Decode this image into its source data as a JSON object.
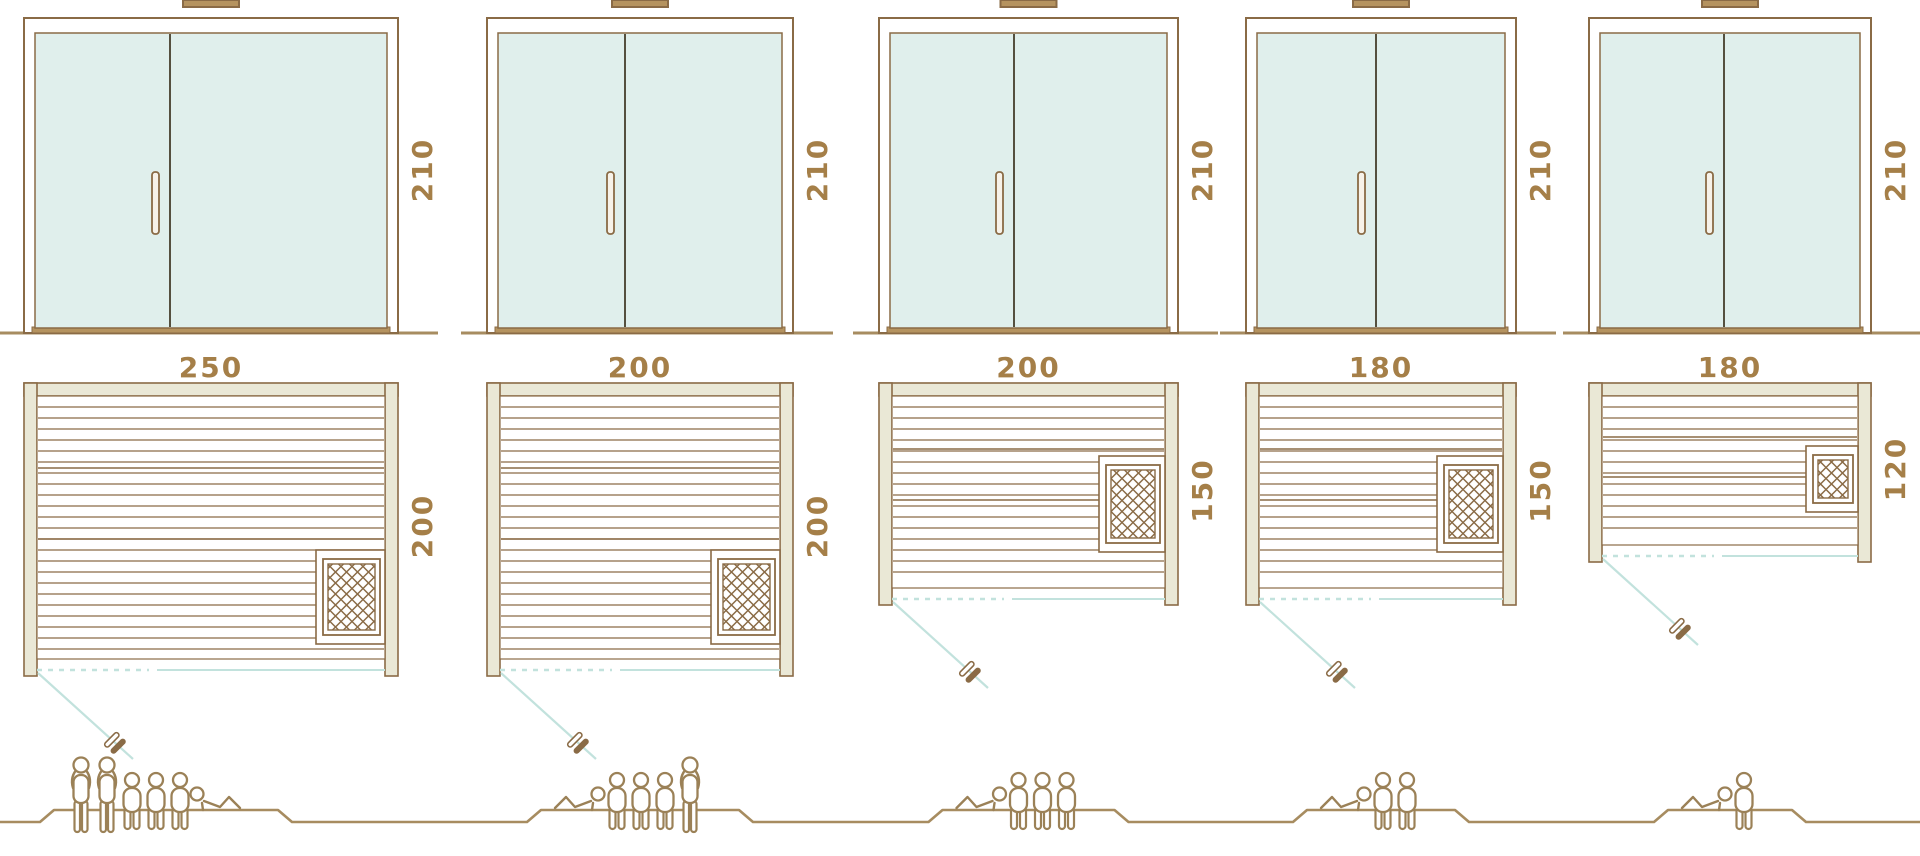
{
  "diagram_title": "sauna-models-size-comparison",
  "colors": {
    "line_brown": "#8a6b46",
    "ground_brown": "#a78c60",
    "label_brown": "#a57f48",
    "glass_teal": "#e0efec",
    "wall_beige": "#eae8d6",
    "swing_teal": "#c2e2dd",
    "divider_dark": "#55503f",
    "figure_brown": "#9b8157",
    "vent_fill": "#b5935f",
    "handle_fill": "#f7f2e9"
  },
  "models": [
    {
      "id": "sauna-250x200",
      "width_label": "250",
      "depth_label": "200",
      "height_label": "210",
      "width_cm": 250,
      "depth_cm": 200,
      "height_cm": 210,
      "x": 24,
      "plan_width_px": 374,
      "plan_depth_px": 286,
      "divider_frac": 0.39,
      "heater": {
        "surround_w": 69,
        "surround_h": 94,
        "anchor": "bottom",
        "frac": 0
      },
      "capacity": {
        "standing": 2,
        "sitting": 3,
        "lying": 1,
        "total": 6
      },
      "figures": [
        "stand",
        "stand",
        "sit",
        "sit",
        "sit",
        "lie-mirror"
      ],
      "people_shift": -45
    },
    {
      "id": "sauna-200x200",
      "width_label": "200",
      "depth_label": "200",
      "height_label": "210",
      "width_cm": 200,
      "depth_cm": 200,
      "height_cm": 210,
      "x": 487,
      "plan_width_px": 306,
      "plan_depth_px": 286,
      "divider_frac": 0.45,
      "heater": {
        "surround_w": 69,
        "surround_h": 94,
        "anchor": "bottom",
        "frac": 0
      },
      "capacity": {
        "standing": 1,
        "sitting": 3,
        "lying": 1,
        "total": 5
      },
      "figures": [
        "lie",
        "sit",
        "sit",
        "sit",
        "stand"
      ],
      "people_shift": 0
    },
    {
      "id": "sauna-200x150",
      "width_label": "200",
      "depth_label": "150",
      "height_label": "210",
      "width_cm": 200,
      "depth_cm": 150,
      "height_cm": 210,
      "x": 879,
      "plan_width_px": 299,
      "plan_depth_px": 215,
      "divider_frac": 0.45,
      "heater": {
        "surround_w": 66,
        "surround_h": 96,
        "anchor": "middle",
        "frac": 0.62
      },
      "capacity": {
        "standing": 0,
        "sitting": 3,
        "lying": 1,
        "total": 4
      },
      "figures": [
        "lie",
        "sit",
        "sit",
        "sit"
      ],
      "people_shift": 0
    },
    {
      "id": "sauna-180x150",
      "width_label": "180",
      "depth_label": "150",
      "height_label": "210",
      "width_cm": 180,
      "depth_cm": 150,
      "height_cm": 210,
      "x": 1246,
      "plan_width_px": 270,
      "plan_depth_px": 215,
      "divider_frac": 0.48,
      "heater": {
        "surround_w": 66,
        "surround_h": 96,
        "anchor": "middle",
        "frac": 0.62
      },
      "capacity": {
        "standing": 0,
        "sitting": 2,
        "lying": 1,
        "total": 3
      },
      "figures": [
        "lie",
        "sit",
        "sit"
      ],
      "people_shift": 0
    },
    {
      "id": "sauna-180x120",
      "width_label": "180",
      "depth_label": "120",
      "height_label": "210",
      "width_cm": 180,
      "depth_cm": 120,
      "height_cm": 210,
      "x": 1589,
      "plan_width_px": 282,
      "plan_depth_px": 172,
      "divider_frac": 0.48,
      "heater": {
        "surround_w": 52,
        "surround_h": 66,
        "anchor": "middle",
        "frac": 0.6
      },
      "capacity": {
        "standing": 0,
        "sitting": 1,
        "lying": 1,
        "total": 2
      },
      "figures": [
        "lie",
        "sit"
      ],
      "people_shift": 0
    }
  ]
}
